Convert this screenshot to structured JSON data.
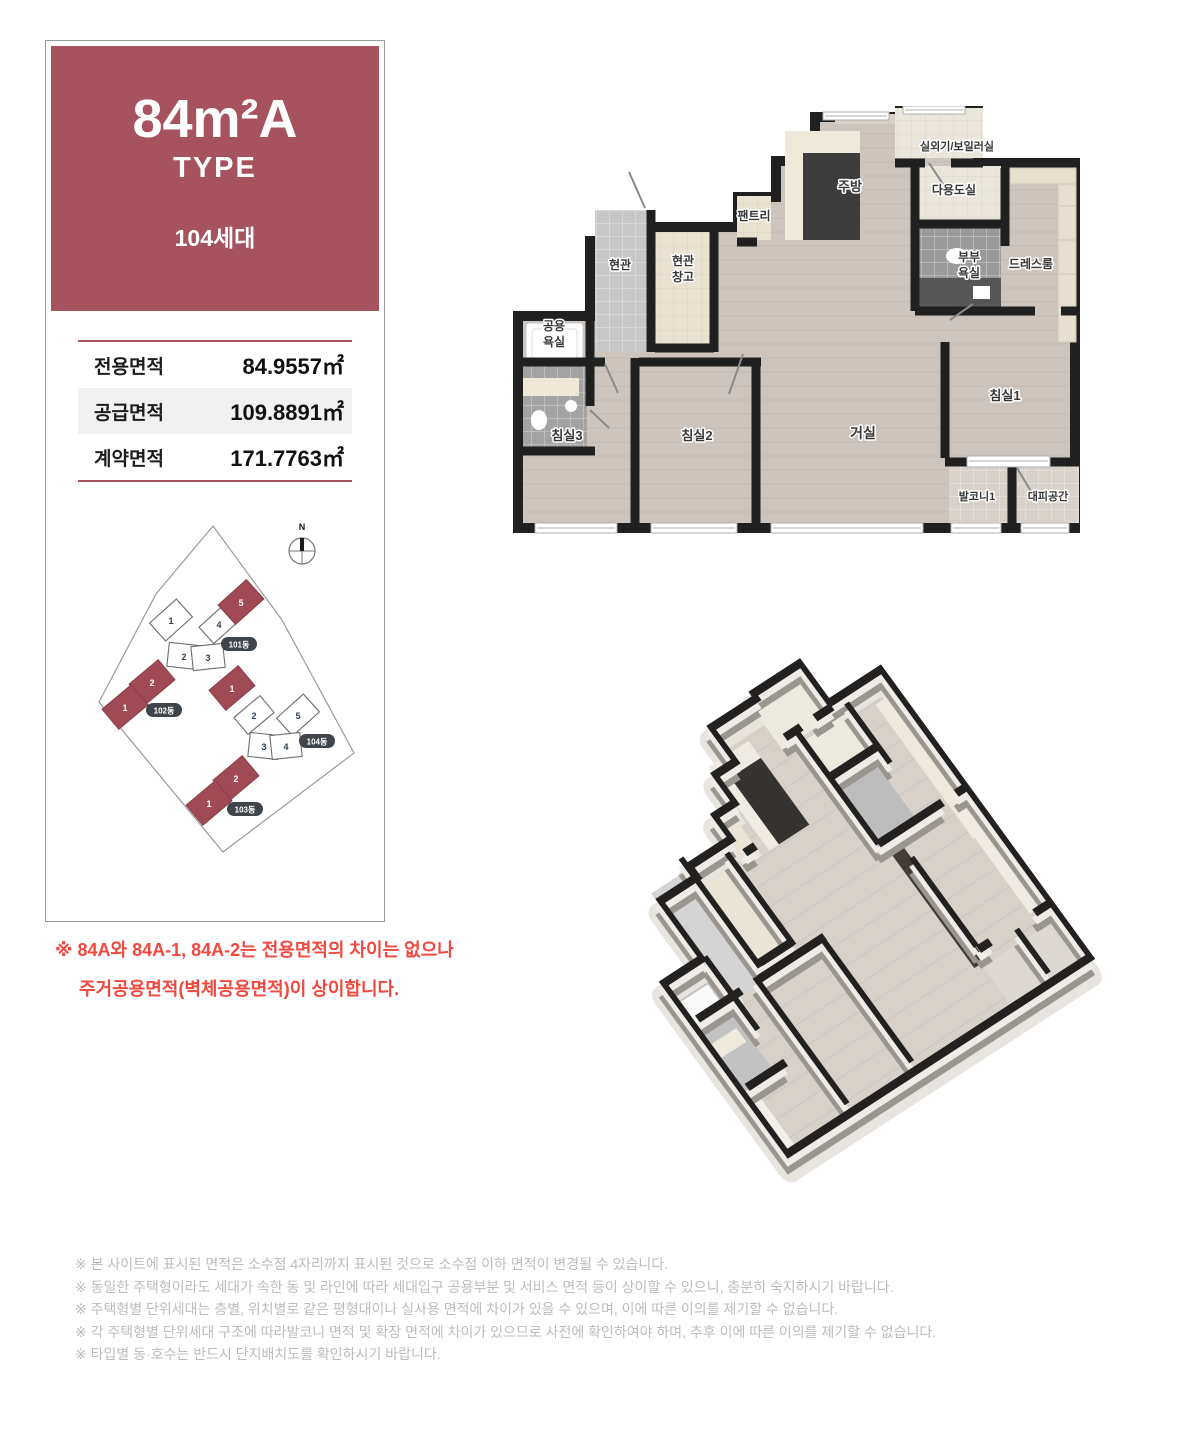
{
  "type_card": {
    "title": "84m²A",
    "subtitle": "TYPE",
    "units_count": "104세대",
    "area_table": {
      "rows": [
        {
          "label": "전용면적",
          "value": "84.9557㎡"
        },
        {
          "label": "공급면적",
          "value": "109.8891㎡"
        },
        {
          "label": "계약면적",
          "value": "171.7763㎡"
        }
      ]
    }
  },
  "site_plan": {
    "compass": "N",
    "b101": {
      "label": "101동",
      "u1": "1",
      "u2": "2",
      "u3": "3",
      "u4": "4",
      "u5": "5"
    },
    "b102": {
      "label": "102동",
      "u1": "1",
      "u2": "2"
    },
    "b103": {
      "label": "103동",
      "u1": "1",
      "u2": "2"
    },
    "b104": {
      "label": "104동",
      "u1": "1",
      "u2": "2",
      "u3": "3",
      "u4": "4",
      "u5": "5"
    }
  },
  "note": {
    "line1": "※ 84A와 84A-1, 84A-2는 전용면적의 차이는 없으나",
    "line2": "주거공용면적(벽체공용면적)이 상이합니다."
  },
  "plan2d": {
    "labels": {
      "boiler": "실외기/보일러실",
      "kitchen": "주방",
      "utility": "다용도실",
      "pantry": "팬트리",
      "entrance": "현관",
      "storage1": "현관",
      "storage2": "창고",
      "bath1a": "공용",
      "bath1b": "욕실",
      "bath2a": "부부",
      "bath2b": "욕실",
      "dress": "드레스룸",
      "bed1": "침실1",
      "bed2": "침실2",
      "bed3": "침실3",
      "living": "거실",
      "balcony": "발코니1",
      "shelter": "대피공간"
    }
  },
  "disclaimers": [
    "※ 본 사이트에 표시된 면적은 소수점 4자리까지 표시된 것으로 소수점 이하 면적이 변경될 수 있습니다.",
    "※ 동일한 주택형이라도 세대가 속한 동 및 라인에 따라 세대입구 공용부분 및 서비스 면적 등이 상이할 수 있으니, 충분히 숙지하시기 바랍니다.",
    "※ 주택형별 단위세대는 층별, 위치별로 같은 평형대이나 실사용 면적에 차이가 있을 수 있으며, 이에 따른 이의를 제기할 수 없습니다.",
    "※ 각 주택형별 단위세대 구조에 따라발코니 면적 및 확장 면적에 차이가 있으므로 사전에 확인하여야 하며, 추후 이에 따른 이의를 제기할 수 없습니다.",
    "※ 타입별 동·호수는 반드시 단지배치도를 확인하시기 바랍니다."
  ],
  "colors": {
    "accent_maroon": "#a7535f",
    "building_red": "#a04a56",
    "pill_bg": "#3f454b",
    "note_red": "#f2483e",
    "wall_black": "#202020",
    "floor_wood": "#ccc4bd",
    "disclaimer_gray": "#bcbcbc"
  }
}
